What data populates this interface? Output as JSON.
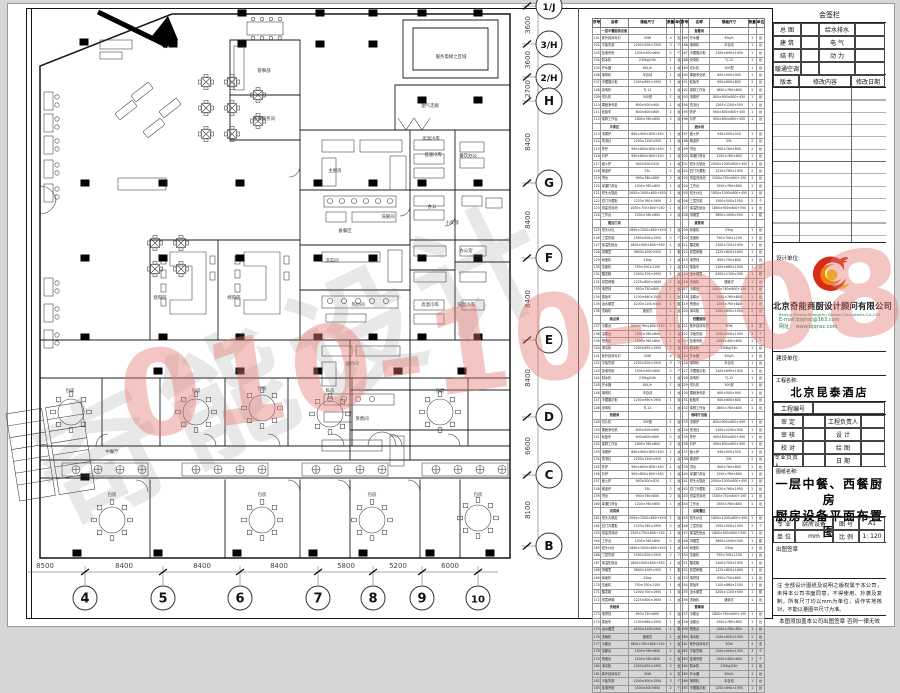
{
  "watermarks": {
    "gray_text": "奇能设计",
    "red_text": "010-10-0086"
  },
  "titleblock": {
    "sign_title": "会签栏",
    "sign_rows": [
      [
        "总 图",
        "给水排水"
      ],
      [
        "建 筑",
        "电 气"
      ],
      [
        "结 构",
        "动 力"
      ],
      [
        "暖通空调",
        ""
      ]
    ],
    "rev_headers": [
      "版本",
      "修改内容",
      "修改日期"
    ],
    "design_label": "设计单位:",
    "company_cn": "北京奇能商厨设计顾问有限公司",
    "company_en": "Beijing Qineng Shangchu Design Consultants Co.,LTD",
    "email": "E-mail:bjqnsc@163.com",
    "website": "网址： www.bjqnsc.com",
    "build_label": "建设单位:",
    "project_label": "工程名称:",
    "project_name": "北京昆泰酒店",
    "project_no_label": "工程编号",
    "person_rows": [
      [
        "审 定",
        "工程负责人"
      ],
      [
        "审 核",
        "设 计"
      ],
      [
        "校 对",
        "绘 图"
      ],
      [
        "专业负责人",
        "日 期"
      ]
    ],
    "drawing_label": "图纸名称:",
    "drawing_line1": "一层中餐、西餐厨房",
    "drawing_line2": "厨房设备平面布置图",
    "meta_rows": [
      [
        "专 业",
        "厨房设备",
        "图 号",
        "A1"
      ],
      [
        "单 位",
        "mm",
        "比 例",
        "1: 120"
      ]
    ],
    "seal_label": "出图签章",
    "note": "注 全部设计图纸及说明之版权属于本公司，未得本公司书面同意，不得使用、抄袭及复制。所有尺寸均以mm为单位，请作实地核对，不能以量图中尺寸为准。",
    "footer": "本图须加盖本公司出图签章 否则一律无效",
    "logo_colors": {
      "red": "#d92b1c",
      "orange": "#f08300",
      "yellow": "#f6c900"
    }
  },
  "equipment_table": {
    "headers": [
      "序号",
      "名称",
      "规格尺寸",
      "数量",
      "单位"
    ],
    "sections": [
      "一层中餐厨房设备",
      "冷库区",
      "粗加工间",
      "面点间",
      "热厨间",
      "凉菜间",
      "洗碗间",
      "备餐间",
      "酒水间",
      "蒸煮间",
      "西餐厨房",
      "咖啡厅设备",
      "自助餐区",
      "管事部"
    ],
    "row_count": 90,
    "left_start": 101,
    "right_start": 185,
    "items": [
      [
        "单通打荷台",
        "1200×760×800",
        "1",
        "台"
      ],
      [
        "双头大锅灶",
        "2000×1000×800+450",
        "1",
        "台"
      ],
      [
        "四门冷藏柜",
        "1220×760×1950",
        "2",
        "台"
      ],
      [
        "双星洗涤池",
        "1500×750×800+150",
        "1",
        "台"
      ],
      [
        "工作台",
        "1500×760×800",
        "2",
        "台"
      ],
      [
        "双头炒灶",
        "1800×1000×800+450",
        "1",
        "台"
      ],
      [
        "三层货架",
        "1500×500×1550",
        "2",
        "个"
      ],
      [
        "保温售饭台",
        "1800×900×800+550",
        "1",
        "台"
      ],
      [
        "排烟罩",
        "3600×1000×500",
        "1",
        "套"
      ],
      [
        "和面机",
        "25kg",
        "1",
        "台"
      ],
      [
        "压面机",
        "750×700×1100",
        "1",
        "台"
      ],
      [
        "醒发箱",
        "1200×700×1950",
        "1",
        "台"
      ],
      [
        "双层烤箱",
        "1225×800×1640",
        "1",
        "台"
      ],
      [
        "电饼铛",
        "650×750×800",
        "1",
        "台"
      ],
      [
        "蒸饭车",
        "1100×660×1500",
        "1",
        "台"
      ],
      [
        "运水烟罩",
        "4200×1100×500",
        "1",
        "套"
      ],
      [
        "洗碗机",
        "通道式",
        "1",
        "台"
      ],
      [
        "污碟台",
        "1800×760×800+150",
        "1",
        "台"
      ],
      [
        "洁碟台",
        "1500×760×800",
        "1",
        "台"
      ],
      [
        "残食台",
        "1200×760×800",
        "1",
        "台"
      ],
      [
        "消毒柜",
        "1200×650×1950",
        "2",
        "台"
      ],
      [
        "紫外线消毒灯",
        "30W",
        "4",
        "支"
      ],
      [
        "平板货架",
        "1200×500×1550",
        "3",
        "个"
      ],
      [
        "挂墙吊柜",
        "1500×400×600",
        "2",
        "个"
      ],
      [
        "制冰机",
        "230kg/24h",
        "1",
        "台"
      ],
      [
        "开水器",
        "60L/h",
        "1",
        "台"
      ],
      [
        "咖啡机",
        "半自动",
        "1",
        "台"
      ],
      [
        "冷藏展示柜",
        "1200×690×1950",
        "1",
        "台"
      ],
      [
        "绞肉机",
        "TJ-12",
        "1",
        "台"
      ],
      [
        "切片机",
        "300型",
        "1",
        "台"
      ],
      [
        "果蔬净化机",
        "800×500×900",
        "1",
        "台"
      ],
      [
        "砧板车",
        "600×600×800",
        "2",
        "台"
      ],
      [
        "保鲜工作台",
        "1800×760×800",
        "2",
        "台"
      ],
      [
        "汤粥炉",
        "800×900×800+450",
        "1",
        "台"
      ],
      [
        "低汤灶",
        "1200×1200×550",
        "1",
        "台"
      ],
      [
        "炸炉",
        "900×800×800+450",
        "1",
        "台"
      ],
      [
        "扒炉",
        "900×800×800+450",
        "1",
        "台"
      ],
      [
        "面火炉",
        "940×500×520",
        "1",
        "台"
      ],
      [
        "微波炉",
        "25L",
        "2",
        "台"
      ],
      [
        "拼台",
        "900×760×800",
        "2",
        "台"
      ]
    ]
  },
  "plan": {
    "grid_rows": [
      [
        "1/J",
        6
      ],
      [
        "3/H",
        44
      ],
      [
        "2/H",
        77
      ],
      [
        "H",
        101
      ],
      [
        "G",
        183
      ],
      [
        "F",
        258
      ],
      [
        "E",
        340
      ],
      [
        "D",
        417
      ],
      [
        "C",
        475
      ],
      [
        "B",
        546
      ]
    ],
    "row_dims": [
      [
        "3600",
        25
      ],
      [
        "3600",
        60
      ],
      [
        "2700",
        89
      ],
      [
        "8400",
        142
      ],
      [
        "8400",
        220
      ],
      [
        "8400",
        299
      ],
      [
        "8400",
        378
      ],
      [
        "6600",
        446
      ],
      [
        "8100",
        510
      ]
    ],
    "grid_cols": [
      [
        "4",
        85
      ],
      [
        "5",
        163
      ],
      [
        "6",
        240
      ],
      [
        "7",
        318
      ],
      [
        "8",
        373
      ],
      [
        "9",
        422
      ],
      [
        "10",
        478
      ]
    ],
    "col_dims": [
      [
        "8500",
        45
      ],
      [
        "8400",
        124
      ],
      [
        "8400",
        202
      ],
      [
        "8400",
        279
      ],
      [
        "5800",
        346
      ],
      [
        "5200",
        398
      ],
      [
        "6000",
        450
      ]
    ],
    "labels": [
      [
        "管事部",
        264,
        72
      ],
      [
        "备餐服务间",
        264,
        120
      ],
      [
        "服务电梯之区域",
        451,
        58
      ],
      [
        "烟气走廊",
        430,
        107
      ],
      [
        "主厨房",
        335,
        172
      ],
      [
        "洗碗间",
        388,
        218
      ],
      [
        "备餐区",
        345,
        232
      ],
      [
        "凉菜间",
        332,
        262
      ],
      [
        "热炒间",
        358,
        306
      ],
      [
        "面点间",
        352,
        365
      ],
      [
        "蒸煮间",
        362,
        420
      ],
      [
        "高温冷库",
        431,
        140
      ],
      [
        "低温冷库",
        433,
        156
      ],
      [
        "餐饮办公",
        468,
        157
      ],
      [
        "办公",
        432,
        208
      ],
      [
        "小卖部",
        452,
        224
      ],
      [
        "办公室",
        466,
        252
      ],
      [
        "高温冷库",
        430,
        306
      ],
      [
        "低温冷库",
        466,
        306
      ],
      [
        "烧肉区",
        160,
        299
      ],
      [
        "烤肉区",
        234,
        299
      ],
      [
        "中餐厅",
        112,
        453
      ],
      [
        "包房",
        70,
        392
      ],
      [
        "包房",
        196,
        392
      ],
      [
        "包房",
        262,
        390
      ],
      [
        "私房",
        330,
        392
      ],
      [
        "包房",
        440,
        392
      ],
      [
        "包房",
        112,
        496
      ],
      [
        "包房",
        262,
        496
      ],
      [
        "包房",
        372,
        496
      ],
      [
        "包房",
        478,
        496
      ]
    ],
    "columns": [
      [
        242,
        13
      ],
      [
        320,
        13
      ],
      [
        373,
        13
      ],
      [
        422,
        13
      ],
      [
        478,
        13
      ],
      [
        173,
        44
      ],
      [
        242,
        44
      ],
      [
        320,
        44
      ],
      [
        373,
        44
      ],
      [
        422,
        100
      ],
      [
        478,
        100
      ],
      [
        84,
        42
      ],
      [
        85,
        183
      ],
      [
        163,
        183
      ],
      [
        240,
        183
      ],
      [
        318,
        183
      ],
      [
        373,
        183
      ],
      [
        422,
        183
      ],
      [
        478,
        183
      ],
      [
        85,
        258
      ],
      [
        163,
        258
      ],
      [
        240,
        258
      ],
      [
        318,
        258
      ],
      [
        373,
        258
      ],
      [
        422,
        258
      ],
      [
        478,
        258
      ],
      [
        85,
        337
      ],
      [
        163,
        337
      ],
      [
        240,
        337
      ],
      [
        318,
        337
      ],
      [
        373,
        337
      ],
      [
        422,
        337
      ],
      [
        478,
        337
      ],
      [
        158,
        371
      ],
      [
        240,
        371
      ],
      [
        318,
        371
      ],
      [
        398,
        371
      ],
      [
        462,
        371
      ],
      [
        85,
        477
      ],
      [
        77,
        553
      ],
      [
        158,
        553
      ],
      [
        237,
        553
      ],
      [
        313,
        553
      ],
      [
        363,
        553
      ],
      [
        430,
        553
      ],
      [
        490,
        553
      ]
    ],
    "walls": [
      [
        300,
        130,
        510,
        130
      ],
      [
        300,
        130,
        300,
        340
      ],
      [
        410,
        130,
        410,
        340
      ],
      [
        455,
        130,
        455,
        340
      ],
      [
        40,
        340,
        510,
        340
      ],
      [
        40,
        378,
        510,
        378
      ],
      [
        40,
        446,
        510,
        446
      ],
      [
        40,
        460,
        510,
        460
      ],
      [
        40,
        478,
        510,
        478
      ],
      [
        102,
        378,
        102,
        446
      ],
      [
        160,
        378,
        160,
        446
      ],
      [
        225,
        378,
        225,
        446
      ],
      [
        288,
        378,
        288,
        446
      ],
      [
        352,
        378,
        352,
        446
      ],
      [
        410,
        378,
        410,
        446
      ],
      [
        468,
        378,
        468,
        446
      ],
      [
        150,
        480,
        150,
        558
      ],
      [
        225,
        480,
        225,
        558
      ],
      [
        300,
        480,
        300,
        558
      ],
      [
        350,
        480,
        350,
        558
      ],
      [
        420,
        480,
        420,
        558
      ],
      [
        460,
        480,
        460,
        558
      ],
      [
        150,
        240,
        150,
        340
      ],
      [
        218,
        240,
        218,
        340
      ],
      [
        150,
        240,
        300,
        240
      ],
      [
        230,
        40,
        230,
        140
      ],
      [
        230,
        40,
        300,
        40
      ],
      [
        230,
        95,
        300,
        95
      ],
      [
        230,
        140,
        300,
        140
      ],
      [
        300,
        40,
        300,
        130
      ],
      [
        395,
        85,
        395,
        130
      ],
      [
        395,
        85,
        510,
        85
      ],
      [
        403,
        20,
        498,
        20
      ],
      [
        403,
        20,
        403,
        78
      ],
      [
        498,
        20,
        498,
        78
      ],
      [
        403,
        78,
        498,
        78
      ],
      [
        413,
        28,
        488,
        28
      ],
      [
        413,
        28,
        413,
        70
      ],
      [
        488,
        28,
        488,
        70
      ],
      [
        413,
        70,
        488,
        70
      ],
      [
        300,
        190,
        510,
        190
      ],
      [
        300,
        245,
        410,
        245
      ],
      [
        300,
        290,
        410,
        290
      ],
      [
        410,
        240,
        510,
        240
      ],
      [
        455,
        262,
        510,
        262
      ],
      [
        410,
        270,
        455,
        270
      ],
      [
        350,
        340,
        350,
        460
      ],
      [
        410,
        340,
        410,
        460
      ],
      [
        350,
        390,
        510,
        390
      ],
      [
        350,
        430,
        510,
        430
      ]
    ],
    "equip": [
      [
        322,
        140,
        32,
        12
      ],
      [
        360,
        140,
        42,
        12
      ],
      [
        322,
        158,
        14,
        28
      ],
      [
        390,
        156,
        16,
        34
      ],
      [
        324,
        196,
        72,
        11
      ],
      [
        326,
        212,
        20,
        10
      ],
      [
        352,
        212,
        44,
        10
      ],
      [
        322,
        252,
        58,
        10
      ],
      [
        388,
        250,
        14,
        32
      ],
      [
        322,
        296,
        76,
        12
      ],
      [
        326,
        314,
        40,
        8
      ],
      [
        322,
        346,
        30,
        10
      ],
      [
        356,
        346,
        44,
        10
      ],
      [
        322,
        362,
        14,
        24
      ],
      [
        324,
        394,
        70,
        11
      ],
      [
        324,
        412,
        28,
        10
      ],
      [
        322,
        440,
        60,
        11
      ],
      [
        390,
        436,
        14,
        30
      ],
      [
        414,
        140,
        30,
        10
      ],
      [
        414,
        154,
        30,
        10
      ],
      [
        414,
        168,
        30,
        10
      ],
      [
        414,
        196,
        30,
        10
      ],
      [
        414,
        210,
        30,
        10
      ],
      [
        414,
        246,
        32,
        10
      ],
      [
        414,
        272,
        32,
        10
      ],
      [
        414,
        300,
        30,
        10
      ],
      [
        414,
        314,
        30,
        10
      ],
      [
        460,
        142,
        24,
        10
      ],
      [
        460,
        158,
        24,
        10
      ],
      [
        462,
        196,
        20,
        10
      ],
      [
        486,
        198,
        16,
        10
      ],
      [
        460,
        246,
        26,
        10
      ],
      [
        460,
        272,
        26,
        10
      ],
      [
        462,
        300,
        22,
        10
      ],
      [
        234,
        46,
        10,
        44
      ],
      [
        100,
        40,
        32,
        9
      ],
      [
        100,
        52,
        22,
        7
      ],
      [
        118,
        178,
        48,
        12
      ]
    ],
    "burners": [
      [
        330,
        201
      ],
      [
        342,
        201
      ],
      [
        354,
        201
      ],
      [
        366,
        201
      ],
      [
        378,
        201
      ],
      [
        390,
        201
      ],
      [
        330,
        301
      ],
      [
        344,
        301
      ],
      [
        358,
        301
      ],
      [
        372,
        301
      ],
      [
        386,
        301
      ],
      [
        330,
        399
      ],
      [
        344,
        399
      ],
      [
        358,
        399
      ],
      [
        372,
        399
      ]
    ],
    "round_tables": [
      [
        71,
        412
      ],
      [
        196,
        412
      ],
      [
        262,
        408
      ],
      [
        330,
        414
      ],
      [
        440,
        412
      ],
      [
        112,
        520
      ],
      [
        262,
        520
      ],
      [
        372,
        520
      ],
      [
        478,
        518
      ]
    ],
    "x_tables": [
      [
        206,
        82
      ],
      [
        232,
        82
      ],
      [
        206,
        108
      ],
      [
        232,
        108
      ],
      [
        206,
        134
      ],
      [
        232,
        134
      ],
      [
        258,
        95
      ],
      [
        258,
        121
      ],
      [
        155,
        243
      ],
      [
        181,
        243
      ],
      [
        155,
        269
      ],
      [
        181,
        269
      ]
    ],
    "buffets": [
      [
        62,
        463
      ],
      [
        182,
        463
      ],
      [
        302,
        463
      ],
      [
        422,
        463
      ]
    ],
    "banquettes": [
      [
        44,
        92
      ],
      [
        44,
        114
      ],
      [
        44,
        136
      ],
      [
        44,
        160
      ],
      [
        44,
        184
      ],
      [
        44,
        278
      ],
      [
        44,
        304
      ],
      [
        44,
        330
      ]
    ],
    "sofas": [
      [
        142,
        92,
        -38
      ],
      [
        170,
        108,
        -38
      ],
      [
        154,
        128,
        -38
      ],
      [
        126,
        110,
        -38
      ]
    ]
  }
}
